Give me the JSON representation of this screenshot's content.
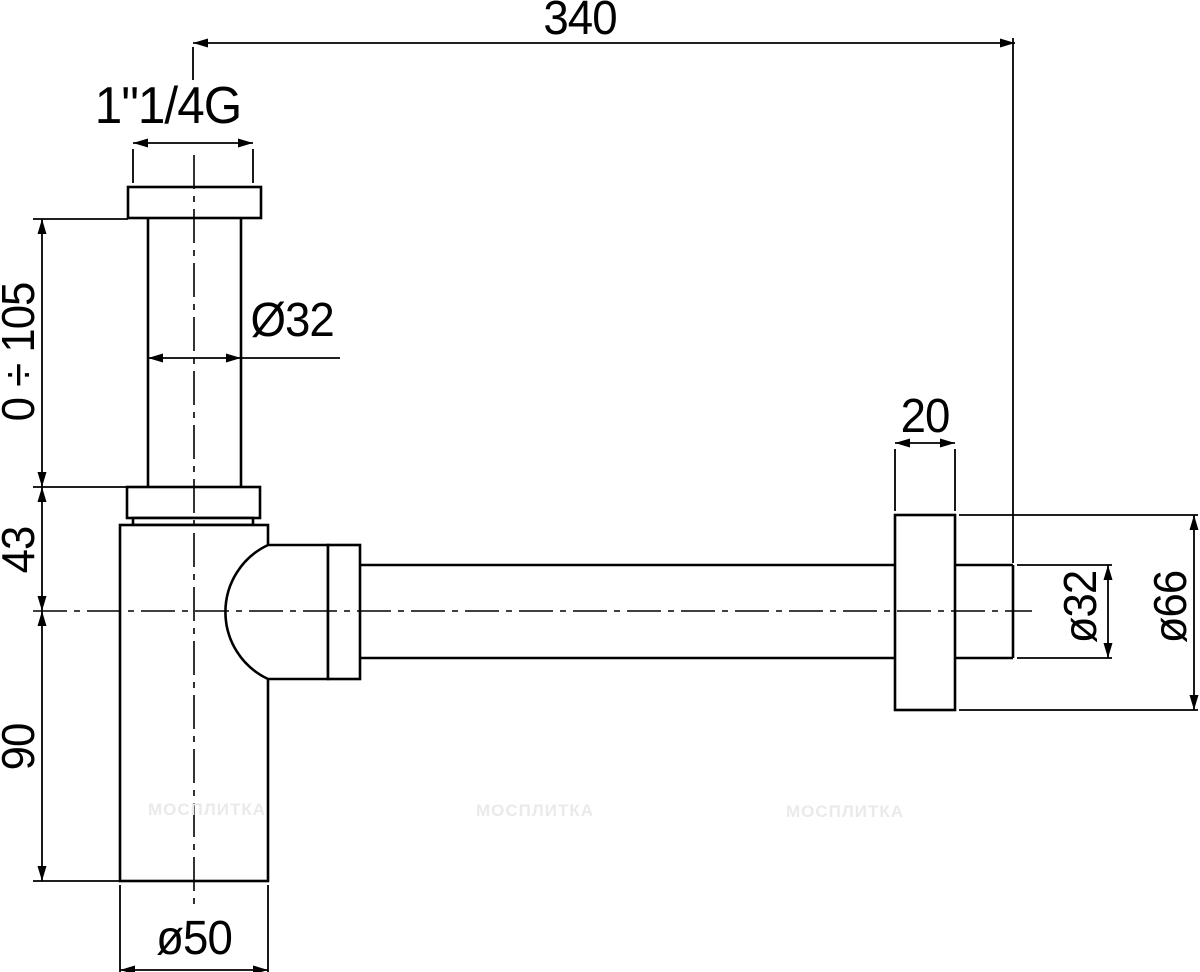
{
  "drawing": {
    "title": "Bottle trap siphon - dimensioned technical drawing",
    "line_color": "#000000",
    "background_color": "#ffffff",
    "watermark_color": "#eaeaea",
    "watermark_text": "МОСПЛИТКА",
    "labels": {
      "span": "340",
      "thread": "1\"1/4G",
      "inlet_diameter": "Ø32",
      "adjustable_height": "0 ÷ 105",
      "offset": "43",
      "body_height": "90",
      "body_diameter": "ø50",
      "flange_thickness": "20",
      "outlet_diameter": "ø32",
      "flange_diameter": "ø66"
    }
  }
}
